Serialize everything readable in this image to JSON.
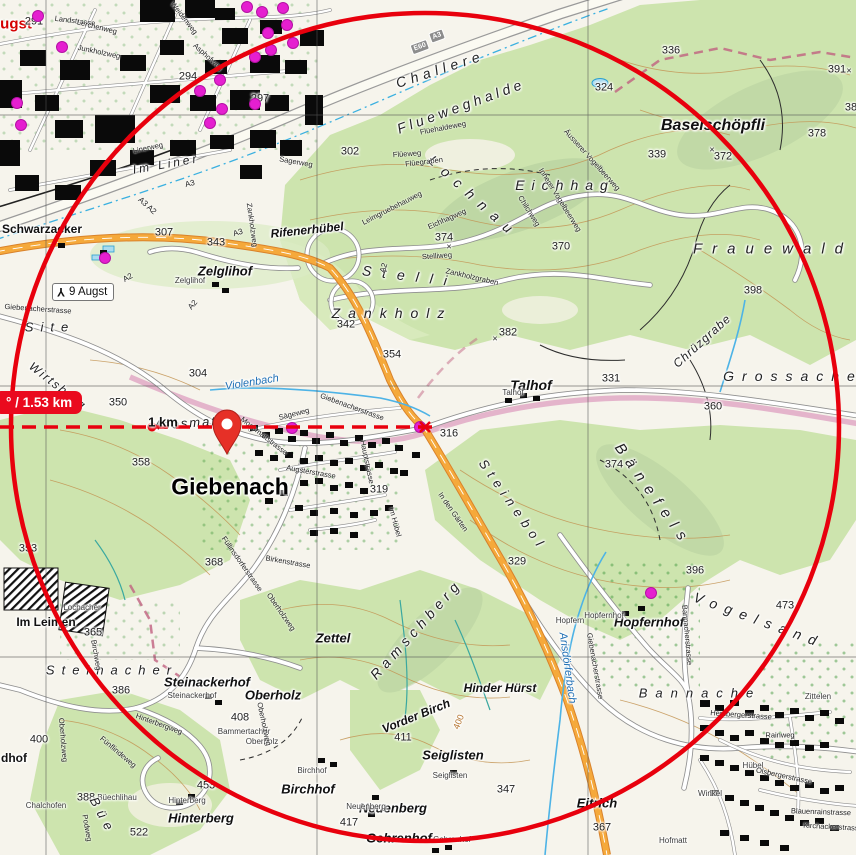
{
  "map": {
    "measure": {
      "distance_label": "° / 1.53 km",
      "km_label": "1 km"
    },
    "junction_sign": {
      "label": "9 Augst",
      "icon": "motorway-junction-icon"
    },
    "shields": [
      {
        "t": "E60",
        "x": 420,
        "y": 47,
        "r": -20
      },
      {
        "t": "A3",
        "x": 437,
        "y": 36,
        "r": -20
      }
    ],
    "colors": {
      "overlay_red": "#e8000d",
      "poi_magenta": "#e51fd0",
      "forest_green": "#cde4ae",
      "motorway_orange": "#f5a93b",
      "water_blue": "#3ab0e0"
    },
    "poi_dots": [
      [
        247,
        7
      ],
      [
        262,
        12
      ],
      [
        283,
        8
      ],
      [
        38,
        16
      ],
      [
        62,
        47
      ],
      [
        17,
        103
      ],
      [
        21,
        125
      ],
      [
        200,
        91
      ],
      [
        220,
        80
      ],
      [
        222,
        109
      ],
      [
        255,
        104
      ],
      [
        268,
        33
      ],
      [
        271,
        50
      ],
      [
        287,
        25
      ],
      [
        293,
        43
      ],
      [
        255,
        57
      ],
      [
        210,
        123
      ],
      [
        105,
        258
      ],
      [
        292,
        428
      ],
      [
        420,
        427
      ],
      [
        651,
        593
      ]
    ],
    "labels": [
      {
        "t": "ugst",
        "x": 16,
        "y": 24,
        "cls": "red"
      },
      {
        "t": "291",
        "x": 34,
        "y": 22,
        "cls": "elev"
      },
      {
        "t": "294",
        "x": 188,
        "y": 77,
        "cls": "elev"
      },
      {
        "t": "297",
        "x": 260,
        "y": 99,
        "cls": "elev"
      },
      {
        "t": "302",
        "x": 350,
        "y": 152,
        "cls": "elev"
      },
      {
        "t": "304",
        "x": 198,
        "y": 374,
        "cls": "elev"
      },
      {
        "t": "307",
        "x": 164,
        "y": 233,
        "cls": "elev"
      },
      {
        "t": "316",
        "x": 449,
        "y": 434,
        "cls": "elev"
      },
      {
        "t": "319",
        "x": 379,
        "y": 490,
        "cls": "elev"
      },
      {
        "t": "324",
        "x": 604,
        "y": 88,
        "cls": "elev"
      },
      {
        "t": "329",
        "x": 517,
        "y": 562,
        "cls": "elev"
      },
      {
        "t": "331",
        "x": 611,
        "y": 379,
        "cls": "elev"
      },
      {
        "t": "336",
        "x": 671,
        "y": 51,
        "cls": "elev"
      },
      {
        "t": "339",
        "x": 657,
        "y": 155,
        "cls": "elev"
      },
      {
        "t": "342",
        "x": 346,
        "y": 325,
        "cls": "elev"
      },
      {
        "t": "343",
        "x": 216,
        "y": 243,
        "cls": "elev"
      },
      {
        "t": "347",
        "x": 506,
        "y": 790,
        "cls": "elev"
      },
      {
        "t": "350",
        "x": 118,
        "y": 403,
        "cls": "elev"
      },
      {
        "t": "353",
        "x": 28,
        "y": 549,
        "cls": "elev"
      },
      {
        "t": "354",
        "x": 392,
        "y": 355,
        "cls": "elev"
      },
      {
        "t": "358",
        "x": 141,
        "y": 463,
        "cls": "elev"
      },
      {
        "t": "360",
        "x": 713,
        "y": 407,
        "cls": "elev"
      },
      {
        "t": "365",
        "x": 93,
        "y": 633,
        "cls": "elev"
      },
      {
        "t": "367",
        "x": 602,
        "y": 828,
        "cls": "elev"
      },
      {
        "t": "368",
        "x": 214,
        "y": 563,
        "cls": "elev"
      },
      {
        "t": "370",
        "x": 561,
        "y": 247,
        "cls": "elev"
      },
      {
        "t": "372",
        "x": 723,
        "y": 157,
        "cls": "elev"
      },
      {
        "t": "374",
        "x": 444,
        "y": 238,
        "cls": "elev"
      },
      {
        "t": "374",
        "x": 614,
        "y": 465,
        "cls": "elev"
      },
      {
        "t": "378",
        "x": 817,
        "y": 134,
        "cls": "elev"
      },
      {
        "t": "382",
        "x": 508,
        "y": 333,
        "cls": "elev"
      },
      {
        "t": "386",
        "x": 121,
        "y": 691,
        "cls": "elev"
      },
      {
        "t": "388",
        "x": 86,
        "y": 798,
        "cls": "elev"
      },
      {
        "t": "391",
        "x": 837,
        "y": 70,
        "cls": "elev"
      },
      {
        "t": "396",
        "x": 695,
        "y": 571,
        "cls": "elev"
      },
      {
        "t": "398",
        "x": 753,
        "y": 291,
        "cls": "elev"
      },
      {
        "t": "400",
        "x": 39,
        "y": 740,
        "cls": "elev"
      },
      {
        "t": "408",
        "x": 240,
        "y": 718,
        "cls": "elev"
      },
      {
        "t": "411",
        "x": 403,
        "y": 738,
        "cls": "elev"
      },
      {
        "t": "417",
        "x": 349,
        "y": 823,
        "cls": "elev"
      },
      {
        "t": "473",
        "x": 785,
        "y": 606,
        "cls": "elev"
      },
      {
        "t": "453",
        "x": 206,
        "y": 786,
        "cls": "elev"
      },
      {
        "t": "522",
        "x": 139,
        "y": 833,
        "cls": "elev"
      },
      {
        "t": "38",
        "x": 851,
        "y": 108,
        "cls": "elev"
      },
      {
        "t": "×",
        "x": 449,
        "y": 247,
        "cls": "elev",
        "fs": 9
      },
      {
        "t": "×",
        "x": 495,
        "y": 339,
        "cls": "elev",
        "fs": 9
      },
      {
        "t": "×",
        "x": 712,
        "y": 150,
        "cls": "elev",
        "fs": 9
      },
      {
        "t": "×",
        "x": 849,
        "y": 71,
        "cls": "elev",
        "fs": 9
      },
      {
        "t": "Giebenach",
        "x": 230,
        "y": 487,
        "cls": "town"
      },
      {
        "t": "Baselschöpfli",
        "x": 713,
        "y": 126,
        "cls": "pl",
        "fs": 16
      },
      {
        "t": "Talhof",
        "x": 531,
        "y": 385,
        "cls": "pl",
        "fs": 14
      },
      {
        "t": "Zelglihof",
        "x": 225,
        "y": 271,
        "cls": "pl"
      },
      {
        "t": "Steinackerhof",
        "x": 207,
        "y": 682,
        "cls": "pl"
      },
      {
        "t": "Oberholz",
        "x": 273,
        "y": 695,
        "cls": "pl"
      },
      {
        "t": "Zettel",
        "x": 333,
        "y": 638,
        "cls": "pl"
      },
      {
        "t": "Hinder Hürst",
        "x": 500,
        "y": 688,
        "cls": "pl",
        "fs": 12
      },
      {
        "t": "Vorder Birch",
        "x": 416,
        "y": 716,
        "cls": "pl",
        "fs": 12,
        "r": -22
      },
      {
        "t": "Seiglisten",
        "x": 453,
        "y": 755,
        "cls": "pl"
      },
      {
        "t": "Birchhof",
        "x": 308,
        "y": 789,
        "cls": "pl"
      },
      {
        "t": "Neuenberg",
        "x": 393,
        "y": 808,
        "cls": "pl"
      },
      {
        "t": "Gehrenhof",
        "x": 399,
        "y": 838,
        "cls": "pl"
      },
      {
        "t": "Eitrich",
        "x": 597,
        "y": 803,
        "cls": "pl"
      },
      {
        "t": "Hinterberg",
        "x": 201,
        "y": 818,
        "cls": "pl"
      },
      {
        "t": "Hopfernhof",
        "x": 649,
        "y": 622,
        "cls": "pl"
      },
      {
        "t": "Im Leimen",
        "x": 46,
        "y": 622,
        "cls": "pl2"
      },
      {
        "t": "Schwarzacker",
        "x": 42,
        "y": 229,
        "cls": "pl2"
      },
      {
        "t": "dhof",
        "x": 14,
        "y": 758,
        "cls": "pl2"
      },
      {
        "t": "Rifenerhübel",
        "x": 307,
        "y": 230,
        "cls": "pl",
        "fs": 12,
        "r": -6
      },
      {
        "t": "Moosmatt",
        "x": 186,
        "y": 423,
        "cls": "area",
        "fs": 13,
        "ls": 2,
        "r": -4
      },
      {
        "t": "Zelglihof",
        "x": 190,
        "y": 281,
        "cls": "sp"
      },
      {
        "t": "Talhof",
        "x": 513,
        "y": 393,
        "cls": "sp"
      },
      {
        "t": "Steinackerhof",
        "x": 192,
        "y": 696,
        "cls": "sp"
      },
      {
        "t": "Seiglisten",
        "x": 450,
        "y": 776,
        "cls": "sp"
      },
      {
        "t": "Birchhof",
        "x": 312,
        "y": 771,
        "cls": "sp"
      },
      {
        "t": "Neuenberg",
        "x": 366,
        "y": 807,
        "cls": "sp"
      },
      {
        "t": "Gehrenhof",
        "x": 452,
        "y": 840,
        "cls": "sp"
      },
      {
        "t": "Hinterberg",
        "x": 187,
        "y": 801,
        "cls": "sp"
      },
      {
        "t": "Hopfernhof",
        "x": 604,
        "y": 616,
        "cls": "sp"
      },
      {
        "t": "Hopfern",
        "x": 570,
        "y": 621,
        "cls": "sp"
      },
      {
        "t": "Lochacher",
        "x": 82,
        "y": 608,
        "cls": "sp"
      },
      {
        "t": "Chalchofen",
        "x": 46,
        "y": 806,
        "cls": "sp"
      },
      {
        "t": "Büechlihau",
        "x": 117,
        "y": 798,
        "cls": "sp"
      },
      {
        "t": "Bammertacher",
        "x": 244,
        "y": 732,
        "cls": "sp"
      },
      {
        "t": "Oberholz",
        "x": 262,
        "y": 742,
        "cls": "sp"
      },
      {
        "t": "Zittelen",
        "x": 818,
        "y": 697,
        "cls": "sp"
      },
      {
        "t": "Hübel",
        "x": 753,
        "y": 766,
        "cls": "sp"
      },
      {
        "t": "Winkel",
        "x": 710,
        "y": 794,
        "cls": "sp"
      },
      {
        "t": "Hofmatt",
        "x": 673,
        "y": 841,
        "cls": "sp"
      },
      {
        "t": "Frauewald",
        "x": 773,
        "y": 249,
        "cls": "area",
        "fs": 15,
        "ls": 10
      },
      {
        "t": "Grossache",
        "x": 793,
        "y": 376,
        "cls": "area",
        "ls": 8
      },
      {
        "t": "Challere",
        "x": 440,
        "y": 69,
        "cls": "area",
        "ls": 5,
        "r": -18
      },
      {
        "t": "Flueweghalde",
        "x": 461,
        "y": 106,
        "cls": "area",
        "ls": 4,
        "r": -20
      },
      {
        "t": "Lochnau",
        "x": 474,
        "y": 197,
        "cls": "area",
        "ls": 9,
        "r": 42
      },
      {
        "t": "Eichhag",
        "x": 565,
        "y": 185,
        "cls": "area",
        "ls": 7
      },
      {
        "t": "Stelli",
        "x": 410,
        "y": 276,
        "cls": "area",
        "ls": 11,
        "r": 7
      },
      {
        "t": "Zankholz",
        "x": 392,
        "y": 313,
        "cls": "area",
        "ls": 8
      },
      {
        "t": "Steinacher",
        "x": 112,
        "y": 670,
        "cls": "area",
        "fs": 13,
        "ls": 7
      },
      {
        "t": "Site",
        "x": 50,
        "y": 327,
        "cls": "area",
        "fs": 13,
        "ls": 7
      },
      {
        "t": "Im Liner",
        "x": 166,
        "y": 164,
        "cls": "area",
        "fs": 12,
        "ls": 3,
        "r": -10
      },
      {
        "t": "Wirtsberg",
        "x": 58,
        "y": 386,
        "cls": "area",
        "fs": 12,
        "ls": 2,
        "r": 38
      },
      {
        "t": "Ramschberg",
        "x": 416,
        "y": 629,
        "cls": "area",
        "ls": 5,
        "r": -48
      },
      {
        "t": "Steinebol",
        "x": 513,
        "y": 505,
        "cls": "area",
        "fs": 13,
        "ls": 6,
        "r": 55
      },
      {
        "t": "Bänefels",
        "x": 653,
        "y": 495,
        "cls": "area",
        "fs": 15,
        "ls": 8,
        "r": 55
      },
      {
        "t": "Vogelsand",
        "x": 759,
        "y": 620,
        "cls": "area",
        "ls": 8,
        "r": 20
      },
      {
        "t": "Bannache",
        "x": 700,
        "y": 693,
        "cls": "area",
        "fs": 13,
        "ls": 8
      },
      {
        "t": "Chrüzgrabe",
        "x": 702,
        "y": 341,
        "cls": "area",
        "fs": 12,
        "ls": 1,
        "r": -42
      },
      {
        "t": "Büe",
        "x": 103,
        "y": 816,
        "cls": "area",
        "fs": 13,
        "ls": 6,
        "r": 62
      },
      {
        "t": "Violenbach",
        "x": 252,
        "y": 383,
        "cls": "water",
        "r": -9
      },
      {
        "t": "Arisdörferbach",
        "x": 567,
        "y": 668,
        "cls": "water",
        "r": 82
      },
      {
        "t": "400",
        "x": 459,
        "y": 722,
        "cls": "cont",
        "r": -68
      },
      {
        "t": "Landstrasse",
        "x": 75,
        "y": 21,
        "cls": "st",
        "r": 7
      },
      {
        "t": "Lerchenweg",
        "x": 97,
        "y": 27,
        "cls": "st",
        "r": 14
      },
      {
        "t": "Junkholzweg",
        "x": 99,
        "y": 52,
        "cls": "st",
        "r": 12
      },
      {
        "t": "Weidenweg",
        "x": 184,
        "y": 18,
        "cls": "st",
        "r": 52
      },
      {
        "t": "Asphofweg",
        "x": 208,
        "y": 57,
        "cls": "st",
        "r": 42
      },
      {
        "t": "Linerweg",
        "x": 148,
        "y": 148,
        "cls": "st",
        "r": -12
      },
      {
        "t": "Sagerweg",
        "x": 296,
        "y": 162,
        "cls": "st",
        "r": 10
      },
      {
        "t": "Giebenacherstrasse",
        "x": 38,
        "y": 309,
        "cls": "st",
        "r": 4
      },
      {
        "t": "Giebenacherstrasse",
        "x": 352,
        "y": 407,
        "cls": "st",
        "r": 20
      },
      {
        "t": "Giebenacherstrasse",
        "x": 595,
        "y": 666,
        "cls": "st",
        "r": 80
      },
      {
        "t": "Sägeweg",
        "x": 294,
        "y": 414,
        "cls": "st",
        "r": -14
      },
      {
        "t": "Moosmattstrasse",
        "x": 264,
        "y": 436,
        "cls": "st",
        "r": 38
      },
      {
        "t": "Augsterstrasse",
        "x": 311,
        "y": 472,
        "cls": "st",
        "r": 10
      },
      {
        "t": "Hauptstrasse",
        "x": 367,
        "y": 462,
        "cls": "st",
        "r": 78
      },
      {
        "t": "In den Gärten",
        "x": 453,
        "y": 512,
        "cls": "st",
        "r": 55
      },
      {
        "t": "Im Hübel",
        "x": 395,
        "y": 522,
        "cls": "st",
        "r": 75
      },
      {
        "t": "Birchweg",
        "x": 96,
        "y": 655,
        "cls": "st",
        "r": 80
      },
      {
        "t": "Füllinsdorferstrasse",
        "x": 242,
        "y": 564,
        "cls": "st",
        "r": 55
      },
      {
        "t": "Birkenstrasse",
        "x": 288,
        "y": 562,
        "cls": "st",
        "r": 10
      },
      {
        "t": "Oberholzweg",
        "x": 281,
        "y": 612,
        "cls": "st",
        "r": 55
      },
      {
        "t": "Oberholzweg",
        "x": 264,
        "y": 724,
        "cls": "st",
        "r": 78
      },
      {
        "t": "Oberholzweg",
        "x": 63,
        "y": 740,
        "cls": "st",
        "r": 85
      },
      {
        "t": "Podweg",
        "x": 87,
        "y": 828,
        "cls": "st",
        "r": 80
      },
      {
        "t": "Fünflindeweg",
        "x": 118,
        "y": 752,
        "cls": "st",
        "r": 40
      },
      {
        "t": "Hinterbergweg",
        "x": 159,
        "y": 724,
        "cls": "st",
        "r": 20
      },
      {
        "t": "Bannacherstrasse",
        "x": 687,
        "y": 635,
        "cls": "st",
        "r": 85
      },
      {
        "t": "Hersbergerstrasse",
        "x": 741,
        "y": 715,
        "cls": "st",
        "r": 4
      },
      {
        "t": "Rainweg",
        "x": 780,
        "y": 735,
        "cls": "st"
      },
      {
        "t": "Olsbergerstrasse",
        "x": 784,
        "y": 776,
        "cls": "st",
        "r": 12
      },
      {
        "t": "Blauenrainstrasse",
        "x": 821,
        "y": 812,
        "cls": "st",
        "r": 2
      },
      {
        "t": "Kirchackerstrasse",
        "x": 833,
        "y": 827,
        "cls": "st",
        "r": 3
      },
      {
        "t": "Stelliweg",
        "x": 437,
        "y": 256,
        "cls": "st",
        "r": -4
      },
      {
        "t": "Zankholzgraben",
        "x": 472,
        "y": 277,
        "cls": "st",
        "r": 13
      },
      {
        "t": "Zankholzweg",
        "x": 252,
        "y": 225,
        "cls": "st",
        "r": 82
      },
      {
        "t": "Flüehaldeweg",
        "x": 443,
        "y": 128,
        "cls": "st",
        "r": -11
      },
      {
        "t": "Flüeweg",
        "x": 407,
        "y": 154,
        "cls": "st",
        "r": -4
      },
      {
        "t": "Flüegraben",
        "x": 424,
        "y": 162,
        "cls": "st",
        "r": -7
      },
      {
        "t": "Leimgruebehauweg",
        "x": 392,
        "y": 208,
        "cls": "st",
        "r": -27
      },
      {
        "t": "Eichhagweg",
        "x": 447,
        "y": 219,
        "cls": "st",
        "r": -24
      },
      {
        "t": "Chilchweg",
        "x": 529,
        "y": 211,
        "cls": "st",
        "r": 58
      },
      {
        "t": "Innerer Vogelbeerweg",
        "x": 560,
        "y": 200,
        "cls": "st",
        "r": 58
      },
      {
        "t": "Äusserer Vogelbeerweg",
        "x": 592,
        "y": 160,
        "cls": "st",
        "r": 48
      },
      {
        "t": "A3 A2",
        "x": 147,
        "y": 206,
        "cls": "st",
        "r": 42,
        "fs": 8
      },
      {
        "t": "A3",
        "x": 190,
        "y": 184,
        "cls": "st",
        "r": -14,
        "fs": 8
      },
      {
        "t": "A3",
        "x": 238,
        "y": 233,
        "cls": "st",
        "r": -16,
        "fs": 8
      },
      {
        "t": "A2",
        "x": 384,
        "y": 268,
        "cls": "st",
        "r": -72,
        "fs": 8
      },
      {
        "t": "A2",
        "x": 128,
        "y": 278,
        "cls": "st",
        "r": -30,
        "fs": 8
      },
      {
        "t": "A2",
        "x": 193,
        "y": 305,
        "cls": "st",
        "r": -50,
        "fs": 8
      }
    ]
  }
}
